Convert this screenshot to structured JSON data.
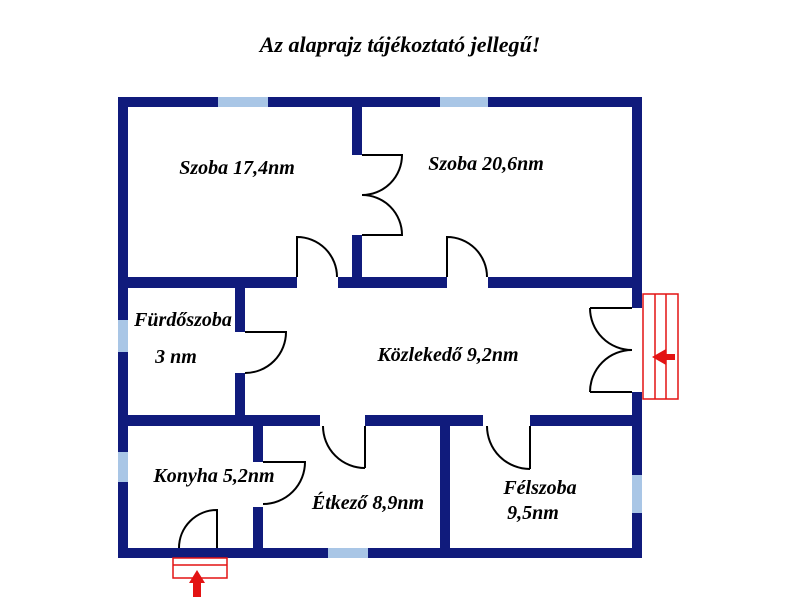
{
  "title": "Az alaprajz tájékoztató jellegű!",
  "rooms": {
    "szoba1": {
      "label": "Szoba 17,4nm"
    },
    "szoba2": {
      "label": "Szoba 20,6nm"
    },
    "furdoszoba": {
      "line1": "Fürdőszoba",
      "line2": "3 nm"
    },
    "kozlekedo": {
      "label": "Közlekedő 9,2nm"
    },
    "konyha": {
      "label": "Konyha 5,2nm"
    },
    "etkezo": {
      "label": "Étkező 8,9nm"
    },
    "felszoba": {
      "line1": "Félszoba",
      "line2": "9,5nm"
    }
  },
  "colors": {
    "wall": "#101b7c",
    "window": "#a9c6e6",
    "door": "#000000",
    "entrance": "#e31313",
    "text": "#000000",
    "background": "#ffffff"
  }
}
